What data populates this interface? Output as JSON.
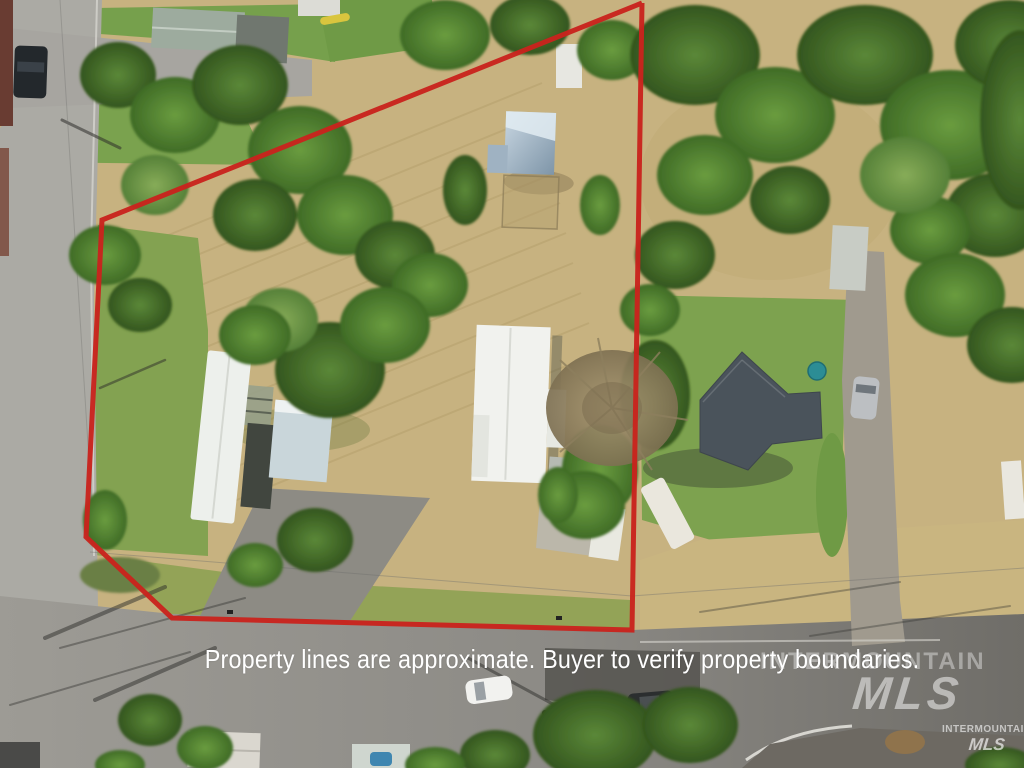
{
  "meta": {
    "type": "aerial-property-listing-photo"
  },
  "overlay": {
    "disclaimer": "Property lines are approximate. Buyer to verify property boundaries.",
    "text_color": "#ffffff"
  },
  "watermark": {
    "large_line1": "INTERMOUNTAIN",
    "large_line2": "MLS",
    "small_line1": "INTERMOUNTAIN",
    "small_line2": "MLS"
  },
  "boundary": {
    "color": "#c9231d",
    "stroke_width": 5,
    "points": "642,3 102,220 86,537 172,618 632,630 642,3"
  }
}
